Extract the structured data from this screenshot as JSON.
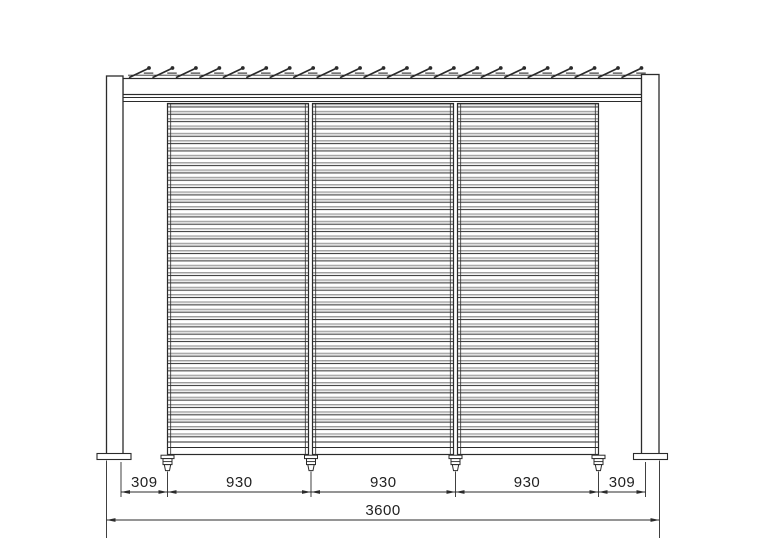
{
  "dimensions": {
    "segment_labels": [
      "309",
      "930",
      "930",
      "930",
      "309"
    ],
    "total_label": "3600"
  },
  "structure": {
    "panel_count": 3,
    "roof_louver_count": 22,
    "leveling_foot_count": 4,
    "slat_rows_per_panel": 46
  },
  "colors": {
    "line": "#2b2b2b",
    "text": "#222222",
    "slat_band": "#9a9a9a",
    "slat_band_light": "#d4d4d4",
    "slat_line": "#424242",
    "background": "#ffffff"
  }
}
